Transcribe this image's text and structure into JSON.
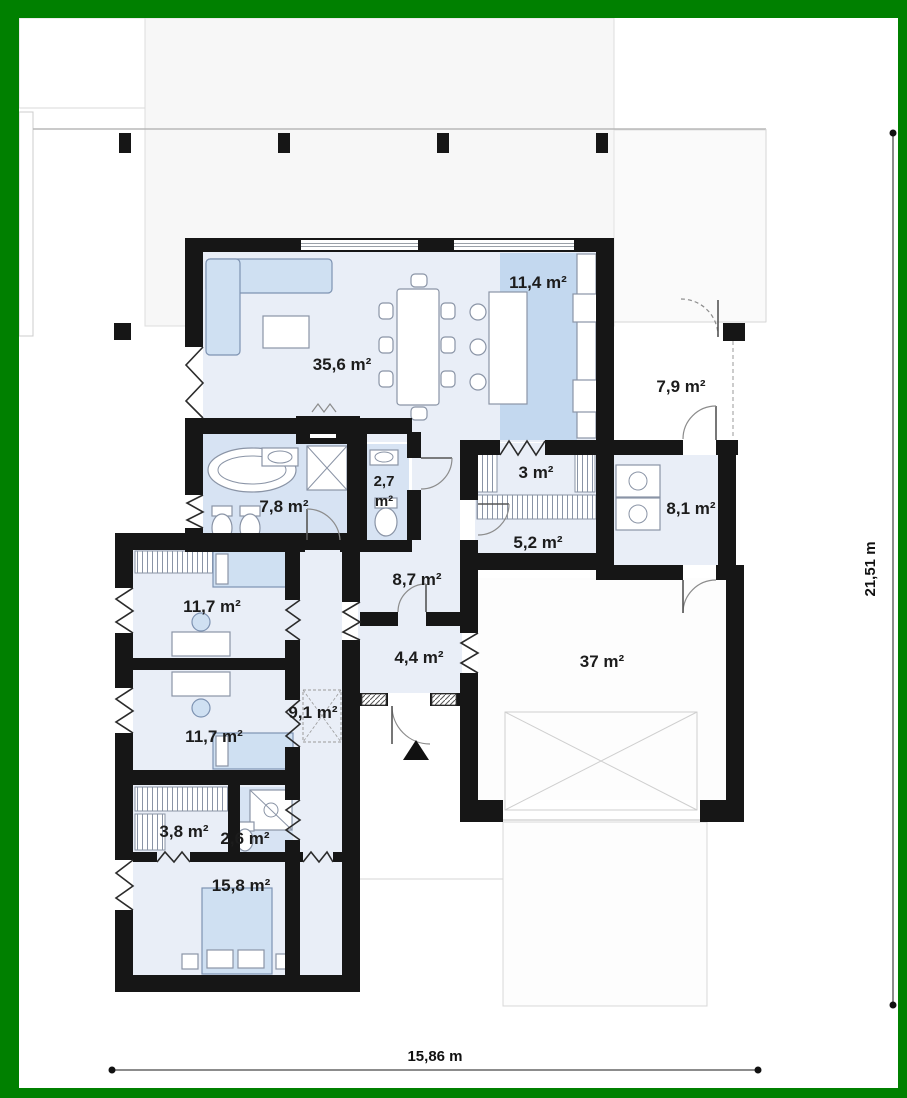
{
  "rooms": [
    {
      "id": "living-dining",
      "area": "35,6 m²"
    },
    {
      "id": "kitchen",
      "area": "11,4 m²"
    },
    {
      "id": "porch",
      "area": "7,9 m²"
    },
    {
      "id": "pantry",
      "area": "3 m²"
    },
    {
      "id": "toilet",
      "area": "2,7 m²",
      "area_line1": "2,7",
      "area_line2": "m²"
    },
    {
      "id": "bathroom",
      "area": "7,8 m²"
    },
    {
      "id": "entrance-hall",
      "area": "8,1 m²"
    },
    {
      "id": "wardrobe-hall",
      "area": "5,2 m²"
    },
    {
      "id": "corridor",
      "area": "8,7 m²"
    },
    {
      "id": "bedroom-1",
      "area": "11,7 m²"
    },
    {
      "id": "vestibule",
      "area": "4,4 m²"
    },
    {
      "id": "garage",
      "area": "37 m²"
    },
    {
      "id": "hallway",
      "area": "9,1 m²"
    },
    {
      "id": "bedroom-2",
      "area": "11,7 m²"
    },
    {
      "id": "wardrobe",
      "area": "3,8 m²"
    },
    {
      "id": "shower-room",
      "area": "2,6 m²"
    },
    {
      "id": "master-bedroom",
      "area": "15,8 m²"
    }
  ],
  "dimensions": {
    "total_width": "15,86 m",
    "total_height": "21,51 m"
  },
  "colors": {
    "frame": "#008000",
    "wall": "#161616",
    "room_fill": "#e9eef7",
    "wet_room_fill": "#d7e3f3",
    "kitchen_strip": "#c3d8ef",
    "furniture_fill": "#cfe0f2",
    "terrace_fill": "#f7f7f7"
  }
}
